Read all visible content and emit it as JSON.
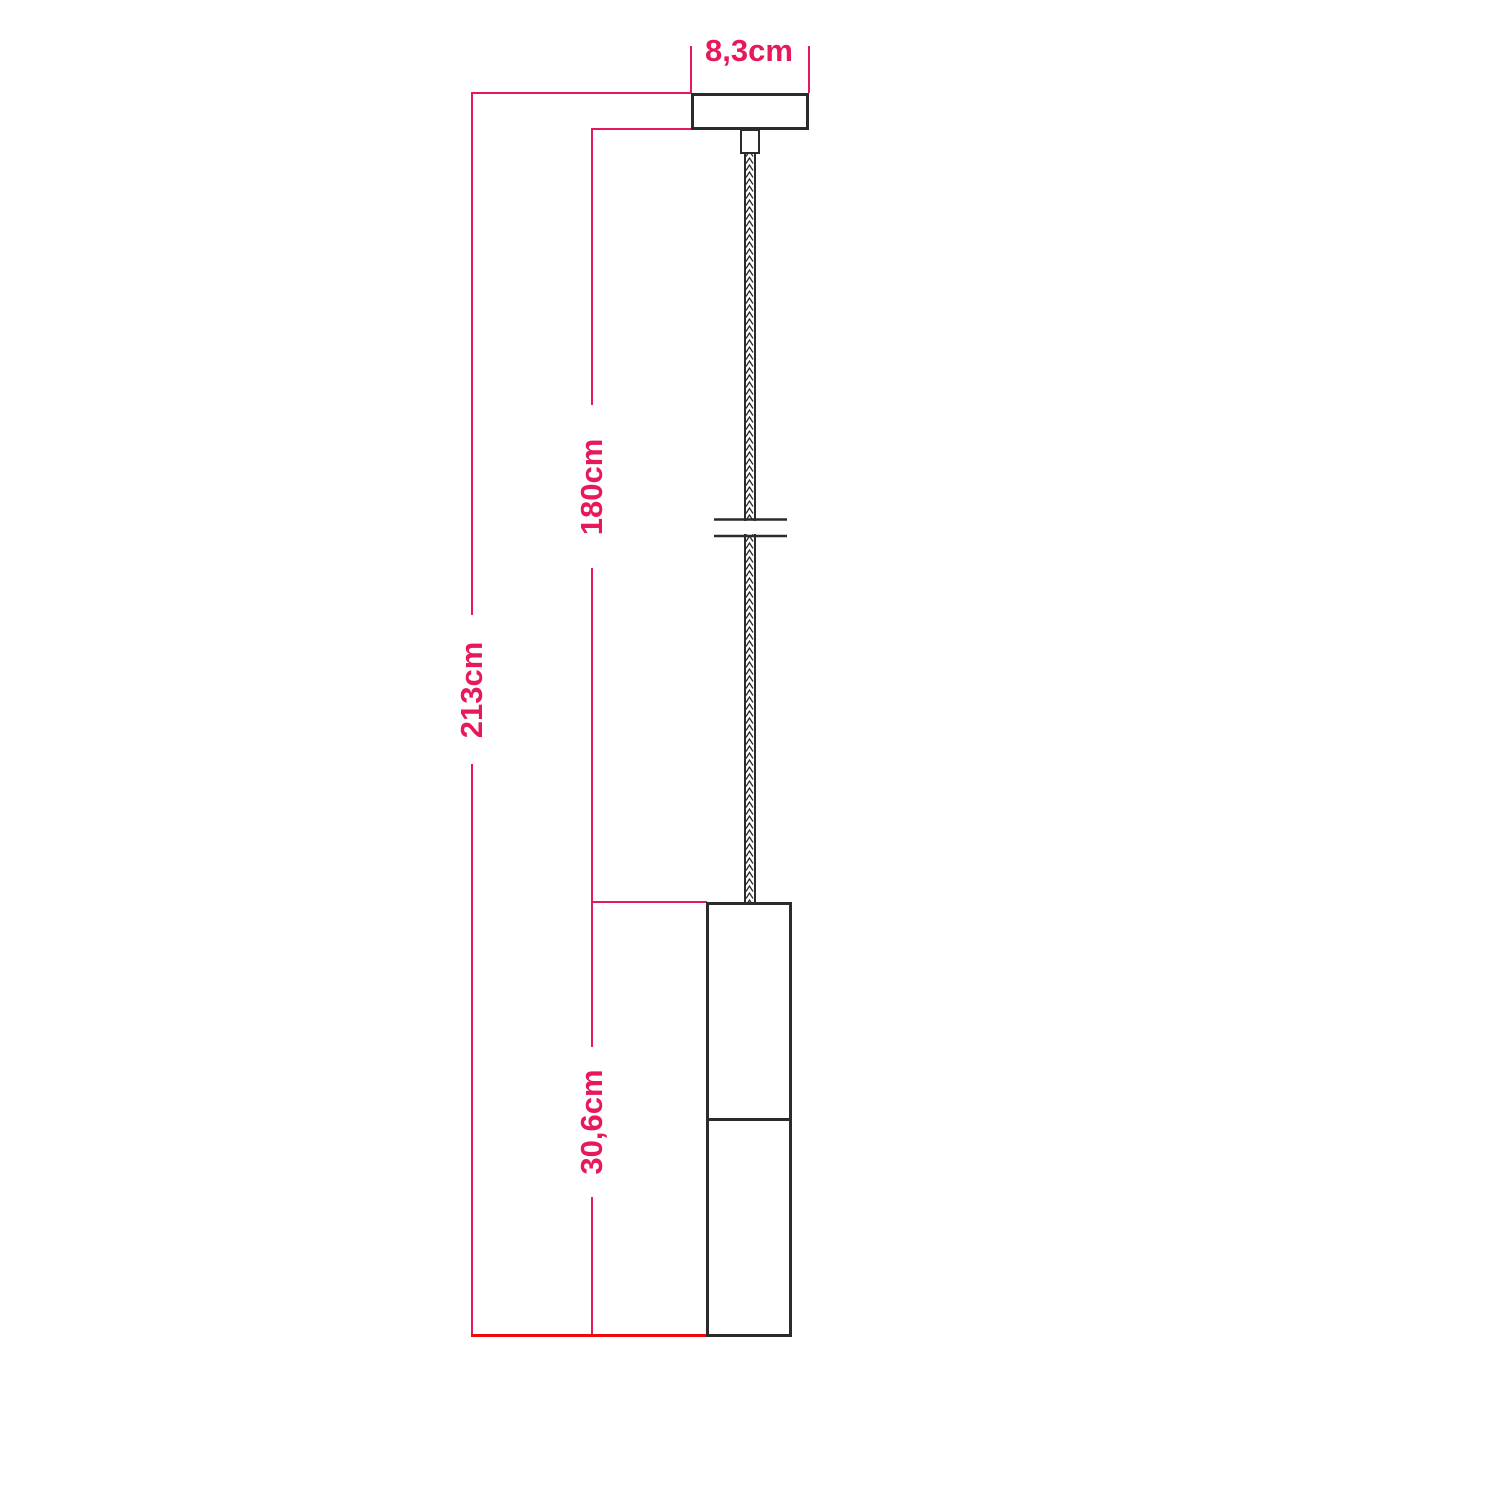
{
  "diagram_title": "pendant-lamp-dimension-drawing",
  "colors": {
    "accent": "#e8195a",
    "baseline-red": "#ee0a0a",
    "outline": "#2b2b2b",
    "canvas-bg": "#ffffff"
  },
  "dimensions": {
    "canopy_width": "8,3cm",
    "total_drop": "213cm",
    "cable_length": "180cm",
    "shade_height": "30,6cm"
  }
}
